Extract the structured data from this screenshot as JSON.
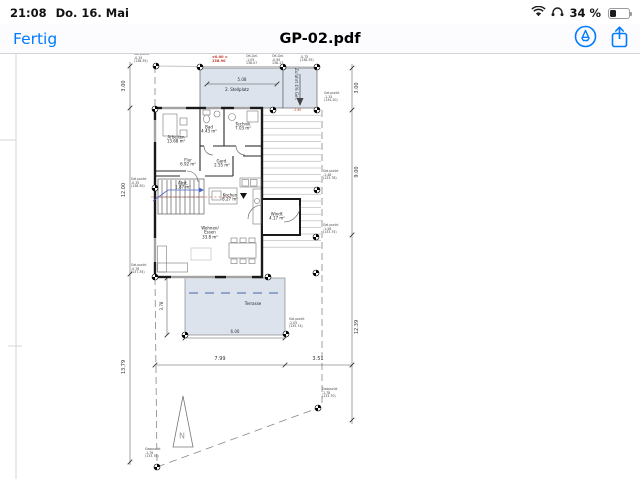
{
  "status_bar": {
    "time": "21:08",
    "date": "Do. 16. Mai",
    "battery_percent": "34 %",
    "icons": {
      "wifi": "wifi-icon",
      "headphones": "headphones-icon",
      "battery": "battery-icon"
    }
  },
  "toolbar": {
    "done_label": "Fertig",
    "title": "GP-02.pdf",
    "icons": {
      "markup": "markup-pen-icon",
      "share": "share-icon"
    }
  },
  "plan": {
    "red_note": "BEZUGSHÖHE:\nOK.FFB. EG\n±0.00 =\n138.90",
    "red_slope": "-1.90",
    "north_letter": "N",
    "rooms": {
      "arbeiten": "Arbeiten\n13.68 m²",
      "bad": "Bad\n4.43 m²",
      "technik": "Technik\n7.03 m²",
      "flur": "Flur\n6.92 m²",
      "garderobe": "Gard.\n2.55 m²",
      "abstell": "Abst.\n1.87 m²",
      "kochen": "Kochen\n8.27 m²",
      "wohnen": "Wohnen/\nEssen\n33.8 m²",
      "windfang": "Windf.\n4.17 m²",
      "stellplatz": "2. Stellplatz",
      "zufahrt": "Zufahrt 4% Gef.",
      "terrasse": "Terrasse"
    },
    "dims": {
      "top_left": "7.99",
      "top_right": "3.51",
      "bottom_left": "7.99",
      "bottom_right": "3.51",
      "left_top": "3.00",
      "left_mid": "12.00",
      "left_bottom": "13.79",
      "right_top": "3.00",
      "right_mid": "9.00",
      "right_bottom": "12.39",
      "parking_width": "5.08",
      "terrace_width": "6.00",
      "terrace_height": "3.78"
    },
    "point_labels": [
      {
        "text": "Gel.punkt\n-0.15\n(138.35)"
      },
      {
        "text": "OK.Gel.\n-1.05\n138.07"
      },
      {
        "text": "OK.Gel.\n-0.95\n138.17"
      },
      {
        "text": "Gel.punkt\n-0.75\n(138.35)"
      },
      {
        "text": "Gel.punkt\n-1.15\n(134.20)"
      },
      {
        "text": "Gel.punkt\n-0.35\n(138.30)"
      },
      {
        "text": "Gel.punkt\n-1.46\n(133.78)"
      },
      {
        "text": "Gel.punkt\n-1.56\n(133.75)"
      },
      {
        "text": "Gel.punkt\n-2.05\n(135.74)"
      },
      {
        "text": "Gel.punkt\n-0.76\n(137.35)"
      },
      {
        "text": "Geopunkt\n-1.76\n(133.76)"
      },
      {
        "text": "Geopunkt\n-1.78\n(133.70)"
      }
    ]
  },
  "colors": {
    "accent": "#007AFF",
    "paving": "#DCE3ED",
    "dim_line": "#444444",
    "red": "#C03528",
    "blue": "#4A63C8"
  }
}
